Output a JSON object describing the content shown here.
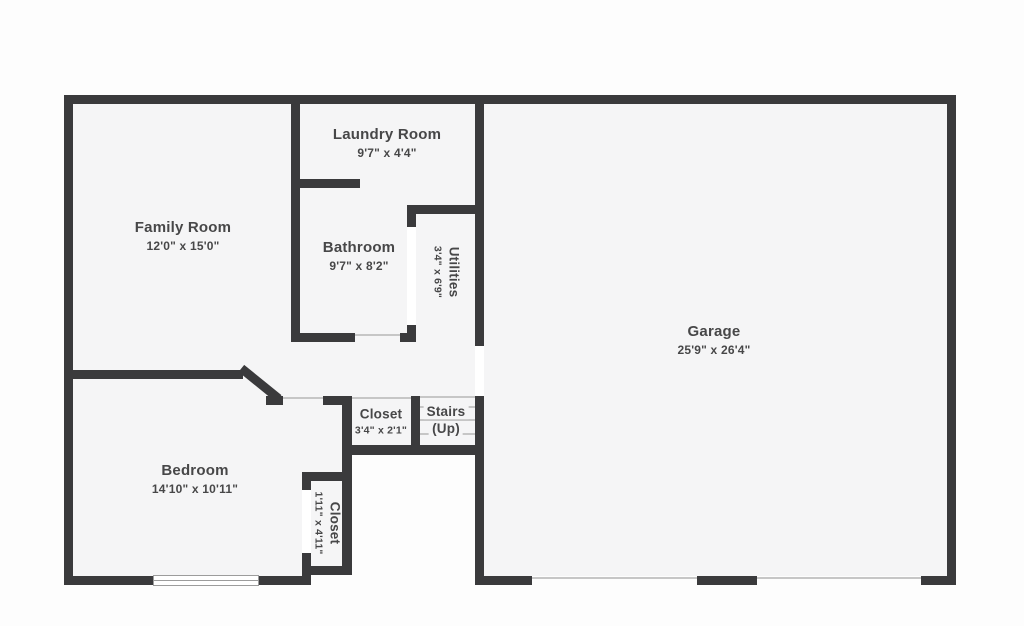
{
  "palette": {
    "wall": "#3a3a3c",
    "room_fill": "#f5f5f6",
    "exterior": "#fdfdfd",
    "opening_line": "#c6c6c6",
    "text": "#474748"
  },
  "rooms": {
    "laundry": {
      "name": "Laundry Room",
      "dims": "9'7\" x 4'4\""
    },
    "family": {
      "name": "Family Room",
      "dims": "12'0\" x 15'0\""
    },
    "bathroom": {
      "name": "Bathroom",
      "dims": "9'7\" x 8'2\""
    },
    "utilities": {
      "name": "Utilities",
      "dims": "3'4\" x 6'9\""
    },
    "garage": {
      "name": "Garage",
      "dims": "25'9\" x 26'4\""
    },
    "closet_hall": {
      "name": "Closet",
      "dims": "3'4\" x 2'1\""
    },
    "stairs": {
      "name": "Stairs",
      "direction": "(Up)"
    },
    "bedroom": {
      "name": "Bedroom",
      "dims": "14'10\" x 10'11\""
    },
    "closet_bedroom": {
      "name": "Closet",
      "dims": "1'11\" x 4'11\""
    }
  }
}
